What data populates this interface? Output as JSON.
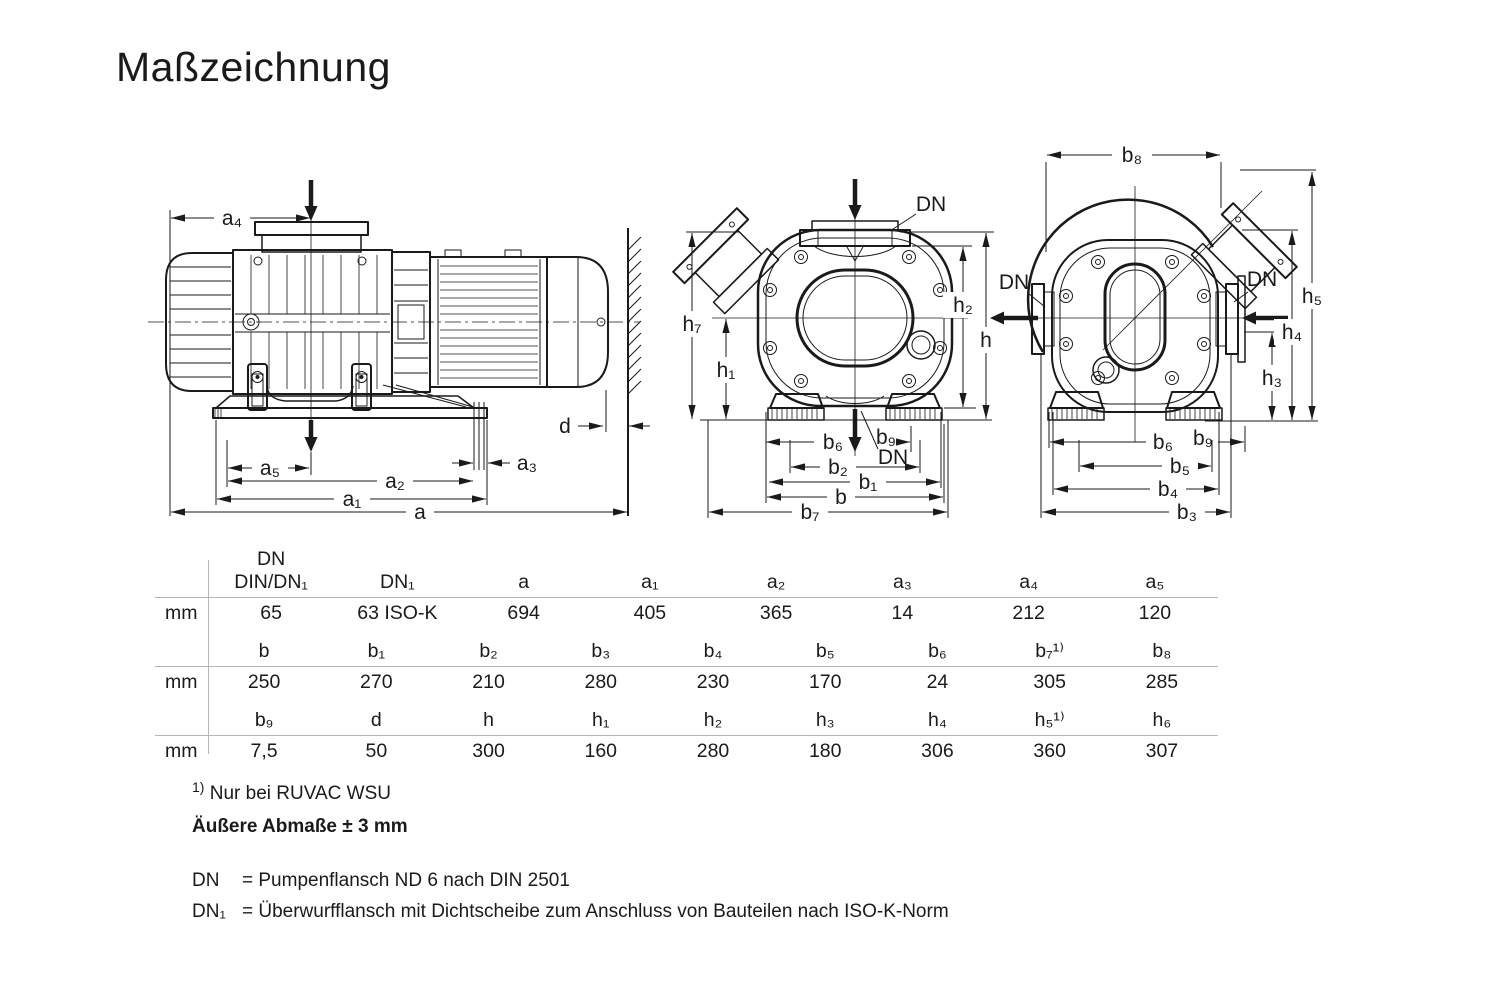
{
  "title": "Maßzeichnung",
  "labels": {
    "left": {
      "a": "a",
      "a1": "a₁",
      "a2": "a₂",
      "a3": "a₃",
      "a4": "a₄",
      "a5": "a₅",
      "d": "d"
    },
    "front": {
      "h": "h",
      "h1": "h₁",
      "h2": "h₂",
      "h7": "h₇",
      "b": "b",
      "b1": "b₁",
      "b2": "b₂",
      "b6": "b₆",
      "b7": "b₇",
      "b9": "b₉",
      "dn_top": "DN",
      "dn_bottom": "DN"
    },
    "rear": {
      "b3": "b₃",
      "b4": "b₄",
      "b5": "b₅",
      "b6": "b₆",
      "b8": "b₈",
      "b9": "b₉",
      "h3": "h₃",
      "h4": "h₄",
      "h5": "h₅",
      "dn_left": "DN",
      "dn_right": "DN"
    }
  },
  "table": {
    "unit_label": "mm",
    "groups": [
      {
        "header_top": "DN",
        "headers": [
          "DIN/DN₁",
          "DN₁",
          "a",
          "a₁",
          "a₂",
          "a₃",
          "a₄",
          "a₅"
        ],
        "values": [
          "65",
          "63 ISO-K",
          "694",
          "405",
          "365",
          "14",
          "212",
          "120"
        ]
      },
      {
        "headers": [
          "b",
          "b₁",
          "b₂",
          "b₃",
          "b₄",
          "b₅",
          "b₆",
          "b₇¹⁾",
          "b₈"
        ],
        "values": [
          "250",
          "270",
          "210",
          "280",
          "230",
          "170",
          "24",
          "305",
          "285"
        ]
      },
      {
        "headers": [
          "b₉",
          "d",
          "h",
          "h₁",
          "h₂",
          "h₃",
          "h₄",
          "h₅¹⁾",
          "h₆"
        ],
        "values": [
          "7,5",
          "50",
          "300",
          "160",
          "280",
          "180",
          "306",
          "360",
          "307"
        ]
      }
    ]
  },
  "footnotes": {
    "note1_marker": "1)",
    "note1_text": "Nur bei RUVAC WSU",
    "note2": "Äußere Abmaße ± 3 mm",
    "dn_term": "DN",
    "dn_text": "= Pumpenflansch ND 6 nach DIN 2501",
    "dn1_term": "DN₁",
    "dn1_text": "= Überwurfflansch mit Dichtscheibe zum Anschluss von Bauteilen nach ISO-K-Norm"
  }
}
